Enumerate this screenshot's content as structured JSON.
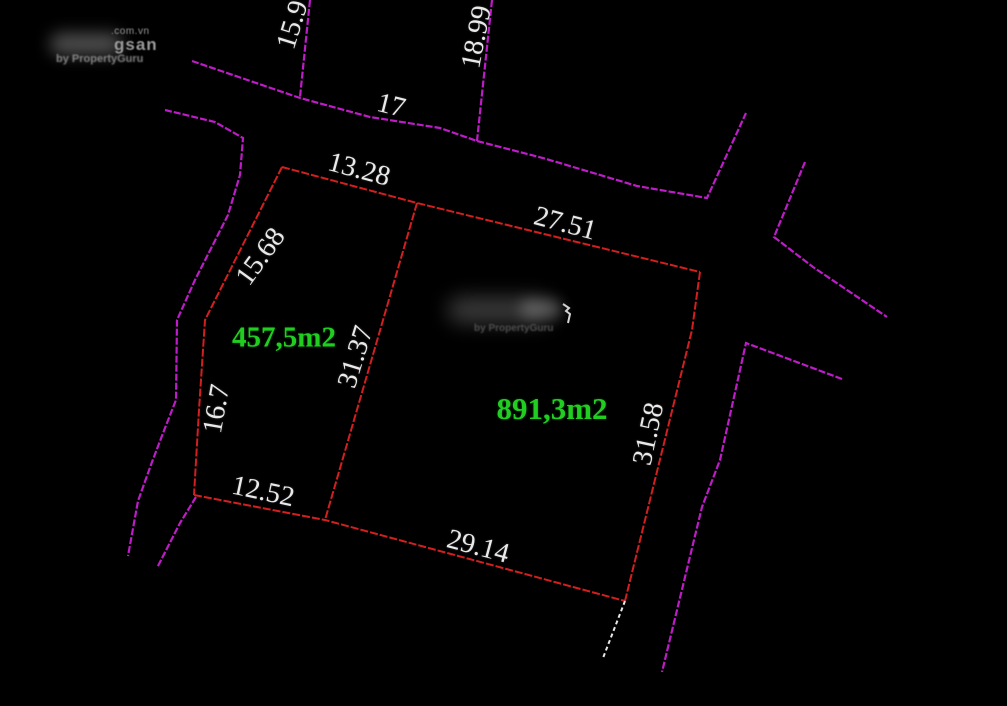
{
  "watermark_top_left": {
    "domain_suffix": ".com.vn",
    "brand_fragment": "gsan",
    "byline": "by PropertyGuru"
  },
  "watermark_center": {
    "byline": "by PropertyGuru"
  },
  "road_dimensions": {
    "left_stub": "15.9",
    "right_stub": "18.99",
    "frontage": "17"
  },
  "parcels": [
    {
      "area": "457,5m2",
      "dimensions": {
        "top": "13.28",
        "left_upper": "15.68",
        "left_lower": "16.7",
        "bottom": "12.52"
      }
    },
    {
      "area": "891,3m2",
      "dimensions": {
        "top": "27.51",
        "right": "31.58",
        "bottom": "29.14",
        "divider_left": "31.37"
      }
    }
  ],
  "colors": {
    "bg": "#000000",
    "road": "#be1cc8",
    "parcel": "#d41f1f",
    "dim-text": "#e9e9e9",
    "area-text": "#22cd22",
    "white-line": "#e8e8e8",
    "watermark": "#9a9a9a"
  }
}
